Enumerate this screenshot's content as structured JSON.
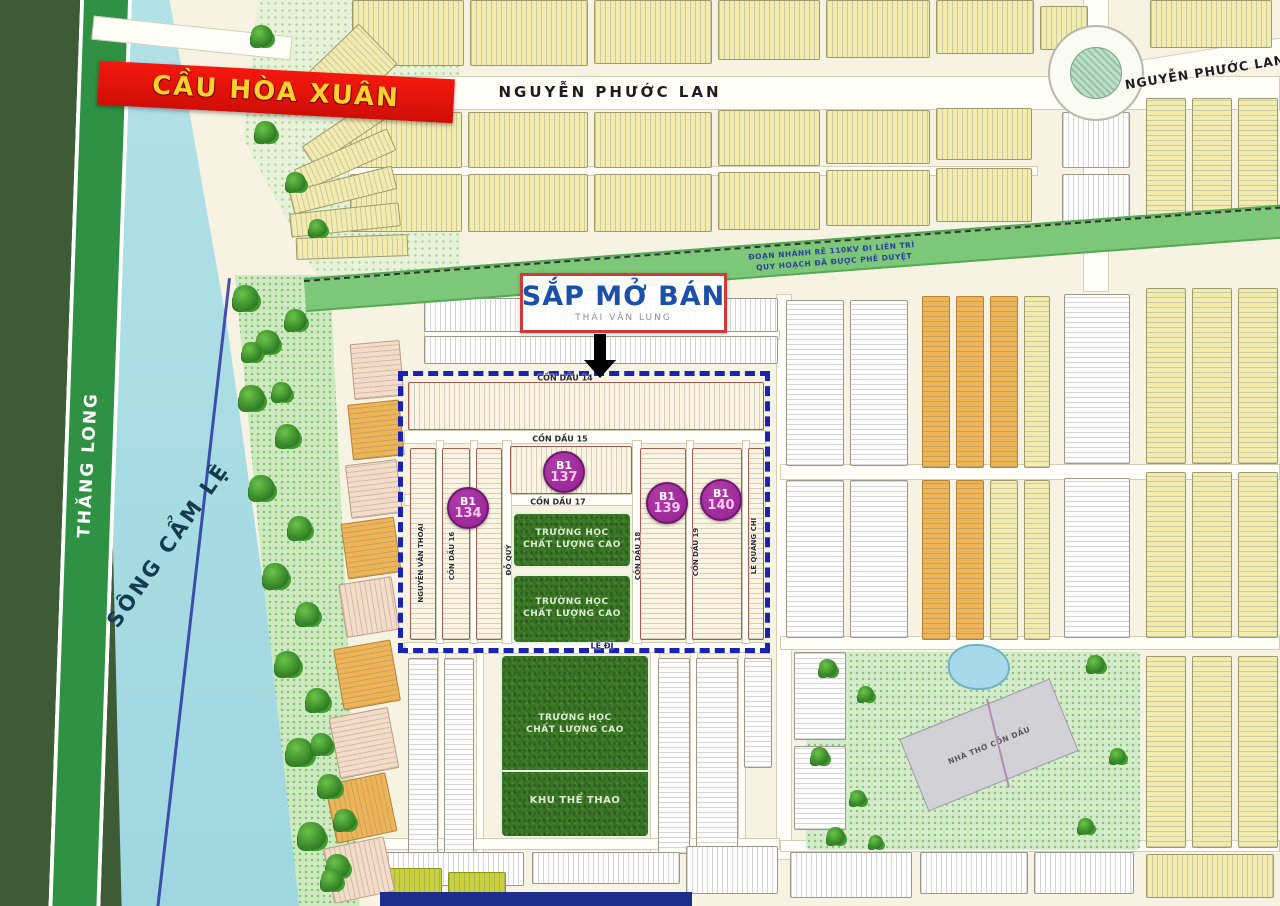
{
  "banners": {
    "bridge": "CẦU HÒA XUÂN",
    "coming_soon": "SẮP MỞ BÁN"
  },
  "streets": {
    "nguyen_phuoc_lan": "NGUYỄN PHƯỚC LAN",
    "nguyen_phuoc_lan_2": "NGUYỄN PHƯỚC LAN",
    "thang_long": "THĂNG LONG",
    "thai_van_lung": "THÁI VĂN LUNG",
    "con_dau_14": "CỒN DẦU 14",
    "con_dau_15": "CỒN DẦU 15",
    "con_dau_16": "CỒN DẦU 16",
    "con_dau_17": "CỒN DẦU 17",
    "con_dau_18": "CỒN DẦU 18",
    "con_dau_19": "CỒN DẦU 19",
    "nguyen_van_thoai": "NGUYỄN VĂN THOẠI",
    "do_quy": "ĐỖ QUÝ",
    "le_quang_chi": "LÊ QUẢNG CHÍ",
    "le_di": "LÊ ĐĨ"
  },
  "river": {
    "name": "SÔNG CẨM LỆ"
  },
  "notes": {
    "power_line_1": "ĐOẠN NHÁNH RẼ 110KV ĐI LIÊN TRÌ",
    "power_line_2": "QUY HOẠCH ĐÃ ĐƯỢC PHÊ DUYỆT"
  },
  "badges": [
    {
      "line1": "B1",
      "line2": "134"
    },
    {
      "line1": "B1",
      "line2": "137"
    },
    {
      "line1": "B1",
      "line2": "139"
    },
    {
      "line1": "B1",
      "line2": "140"
    }
  ],
  "areas": {
    "school_line1": "TRƯỜNG HỌC",
    "school_line2": "CHẤT LƯỢNG CAO",
    "sport": "KHU THỂ THAO",
    "church": "NHÀ THỜ CỒN DẦU"
  },
  "colors": {
    "highlight_border": "#1a22b0",
    "badge_purple": "#a22b9e",
    "banner_red": "#e91208",
    "banner_text": "#ffd02e",
    "coming_soon_text": "#1b50a8",
    "school_green": "#3c7a26",
    "river_blue": "#a9dde4",
    "parcel_yellow": "#f2ecae",
    "parcel_orange": "#edb556"
  }
}
